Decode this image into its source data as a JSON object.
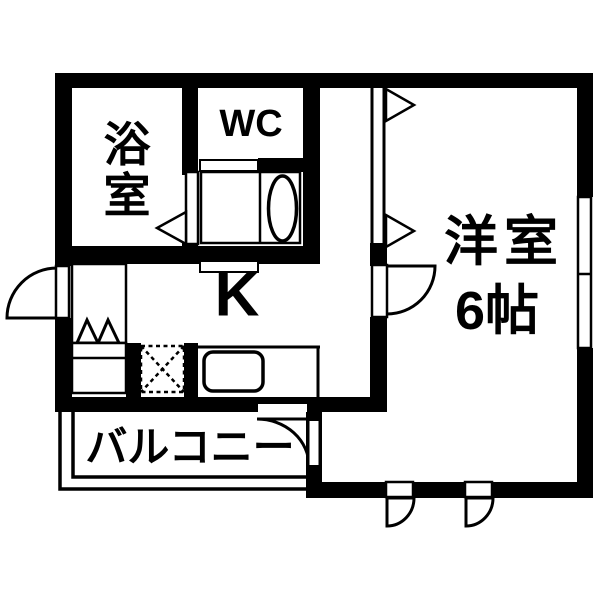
{
  "plan": {
    "title": "1K apartment floor plan",
    "rooms": {
      "bathroom": {
        "label": "浴室"
      },
      "toilet": {
        "label": "WC"
      },
      "kitchen": {
        "label": "K"
      },
      "western_room": {
        "label": "洋室",
        "size": "6帖"
      },
      "balcony": {
        "label": "バルコニー"
      }
    },
    "icons": {
      "toilet-icon": "oval bowl with tank box",
      "kitchen-sink-icon": "rounded rectangle in counter",
      "washing-machine-icon": "dotted square with X",
      "stove-icon": "double triangle peaks on cabinet",
      "door-swing-icon": "quarter-circle arc with leaf",
      "folding-door-icon": "track line with hollow triangle",
      "window-icon": "white slot in wall with center divider"
    },
    "colors": {
      "wall": "#000000",
      "floor": "#ffffff",
      "line": "#000000"
    }
  }
}
